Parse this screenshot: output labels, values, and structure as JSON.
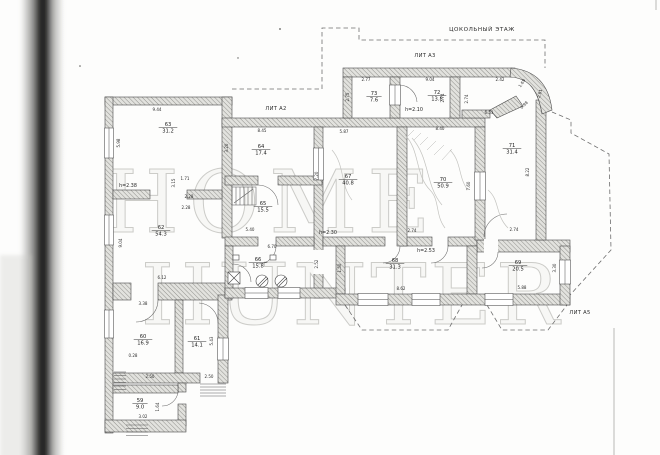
{
  "document": {
    "floor_title": "ЦОКОЛЬНЫЙ ЭТАЖ",
    "watermark_line1": "HOME",
    "watermark_line2": "HUNTER"
  },
  "colors": {
    "paper": "#fdfdfc",
    "wall_hatch": "#8f8f8b",
    "ink": "#2b2b2b",
    "watermark": "#bcbcb8",
    "scan_band": "#161614"
  },
  "building_labels": [
    {
      "text": "ЛИТ А3",
      "x": 425,
      "y": 57
    },
    {
      "text": "ЛИТ А2",
      "x": 276,
      "y": 110
    },
    {
      "text": "ЛИТ А5",
      "x": 580,
      "y": 314
    }
  ],
  "rooms": [
    {
      "number": "63",
      "area": "31.2",
      "x": 168,
      "y": 126
    },
    {
      "number": "64",
      "area": "17.4",
      "x": 261,
      "y": 148
    },
    {
      "number": "62",
      "area": "54.3",
      "x": 161,
      "y": 229
    },
    {
      "number": "65",
      "area": "15.5",
      "x": 263,
      "y": 205
    },
    {
      "number": "66",
      "area": "15.8",
      "x": 258,
      "y": 261
    },
    {
      "number": "67",
      "area": "40.8",
      "x": 348,
      "y": 178
    },
    {
      "number": "70",
      "area": "50.9",
      "x": 443,
      "y": 181
    },
    {
      "number": "71",
      "area": "31.4",
      "x": 512,
      "y": 147
    },
    {
      "number": "72",
      "area": "13.8",
      "x": 437,
      "y": 94
    },
    {
      "number": "73",
      "area": "7.6",
      "x": 374,
      "y": 95
    },
    {
      "number": "68",
      "area": "31.3",
      "x": 395,
      "y": 262
    },
    {
      "number": "69",
      "area": "20.5",
      "x": 518,
      "y": 264
    },
    {
      "number": "60",
      "area": "16.9",
      "x": 143,
      "y": 338
    },
    {
      "number": "61",
      "area": "14.1",
      "x": 197,
      "y": 340
    },
    {
      "number": "59",
      "area": "9.0",
      "x": 140,
      "y": 402
    }
  ],
  "ceiling_heights": [
    {
      "text": "h=2.38",
      "x": 128,
      "y": 187
    },
    {
      "text": "h=2.10",
      "x": 414,
      "y": 111
    },
    {
      "text": "h=2.30",
      "x": 328,
      "y": 234
    },
    {
      "text": "h=2.53",
      "x": 426,
      "y": 252
    }
  ],
  "dimensions": [
    {
      "v": "9.44",
      "x": 157,
      "y": 111,
      "r": 0
    },
    {
      "v": "5.98",
      "x": 120,
      "y": 143,
      "r": 90
    },
    {
      "v": "3.15",
      "x": 175,
      "y": 183,
      "r": 90
    },
    {
      "v": "1.71",
      "x": 185,
      "y": 180,
      "r": 0
    },
    {
      "v": "2.28",
      "x": 189,
      "y": 198,
      "r": 0
    },
    {
      "v": "2.28",
      "x": 186,
      "y": 209,
      "r": 0
    },
    {
      "v": "9.04",
      "x": 122,
      "y": 243,
      "r": 90
    },
    {
      "v": "6.12",
      "x": 162,
      "y": 279,
      "r": 0
    },
    {
      "v": "8.45",
      "x": 262,
      "y": 132,
      "r": 0
    },
    {
      "v": "3.20",
      "x": 228,
      "y": 148,
      "r": 90
    },
    {
      "v": "5.40",
      "x": 250,
      "y": 231,
      "r": 0
    },
    {
      "v": "5.87",
      "x": 344,
      "y": 133,
      "r": 0
    },
    {
      "v": "8.40",
      "x": 440,
      "y": 130,
      "r": 0
    },
    {
      "v": "7.20",
      "x": 318,
      "y": 176,
      "r": 90
    },
    {
      "v": "7.60",
      "x": 470,
      "y": 186,
      "r": 90
    },
    {
      "v": "8.22",
      "x": 529,
      "y": 172,
      "r": 90
    },
    {
      "v": "6.53",
      "x": 489,
      "y": 114,
      "r": 0
    },
    {
      "v": "2.77",
      "x": 366,
      "y": 81,
      "r": 0
    },
    {
      "v": "2.75",
      "x": 349,
      "y": 97,
      "r": 90
    },
    {
      "v": "9.04",
      "x": 430,
      "y": 81,
      "r": 0
    },
    {
      "v": "2.74",
      "x": 444,
      "y": 98,
      "r": 90
    },
    {
      "v": "2.74",
      "x": 468,
      "y": 99,
      "r": 90
    },
    {
      "v": "2.42",
      "x": 500,
      "y": 81,
      "r": 0
    },
    {
      "v": "1.69",
      "x": 523,
      "y": 84,
      "r": 55
    },
    {
      "v": "2.81",
      "x": 541,
      "y": 94,
      "r": 75
    },
    {
      "v": "0.98",
      "x": 525,
      "y": 106,
      "r": 45
    },
    {
      "v": "2.74",
      "x": 514,
      "y": 231,
      "r": 0
    },
    {
      "v": "2.74",
      "x": 412,
      "y": 232,
      "r": 0
    },
    {
      "v": "6.70",
      "x": 272,
      "y": 248,
      "r": 0
    },
    {
      "v": "2.52",
      "x": 318,
      "y": 264,
      "r": 90
    },
    {
      "v": "1.50",
      "x": 341,
      "y": 268,
      "r": 90
    },
    {
      "v": "8.62",
      "x": 401,
      "y": 290,
      "r": 0
    },
    {
      "v": "5.88",
      "x": 522,
      "y": 289,
      "r": 0
    },
    {
      "v": "3.30",
      "x": 556,
      "y": 268,
      "r": 90
    },
    {
      "v": "3.38",
      "x": 143,
      "y": 305,
      "r": 0
    },
    {
      "v": "0.28",
      "x": 133,
      "y": 357,
      "r": 0
    },
    {
      "v": "2.50",
      "x": 150,
      "y": 378,
      "r": 0
    },
    {
      "v": "2.50",
      "x": 209,
      "y": 378,
      "r": 0
    },
    {
      "v": "5.43",
      "x": 213,
      "y": 341,
      "r": 90
    },
    {
      "v": "3.02",
      "x": 143,
      "y": 418,
      "r": 0
    },
    {
      "v": "1.64",
      "x": 159,
      "y": 407,
      "r": 90
    }
  ]
}
